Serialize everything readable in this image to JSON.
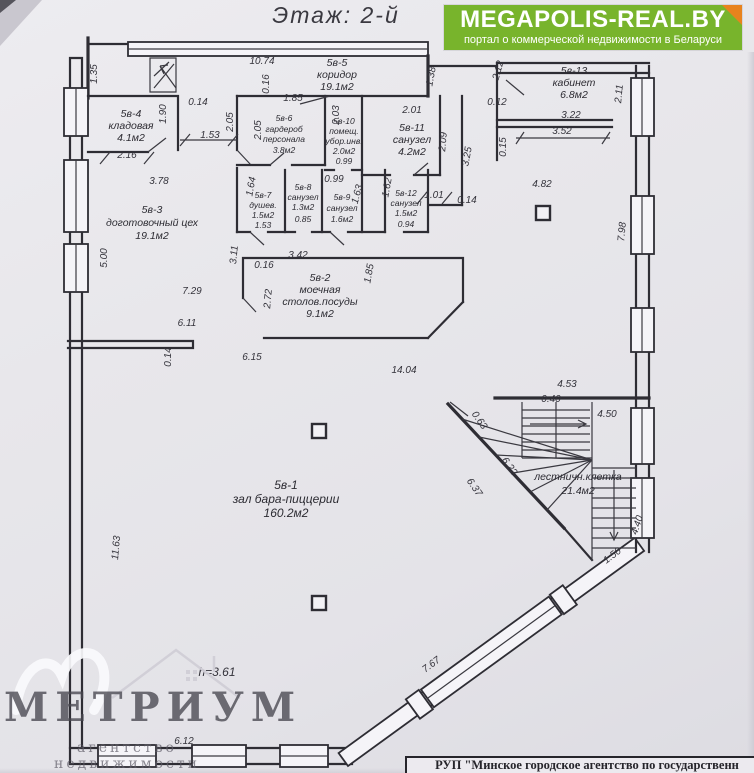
{
  "title": "Этаж: 2-й",
  "banner": {
    "brand": "MEGAPOLIS-REAL.BY",
    "tagline": "портал о коммерческой недвижимости в Беларуси",
    "bg_color": "#78b42c",
    "corner_color": "#e8831d"
  },
  "note_height": "h=3.61",
  "rooms": [
    {
      "id": "5в-4",
      "name": "кладовая",
      "area": "4.1м2"
    },
    {
      "id": "5в-5",
      "name": "коридор",
      "area": "19.1м2"
    },
    {
      "id": "5в-6",
      "name": "гардероб",
      "name2": "персонала",
      "area": "3.8м2"
    },
    {
      "id": "5в-10",
      "name": "помещ.",
      "name2": "убор.инв.",
      "area": "2.0м2",
      "extra": "0.99"
    },
    {
      "id": "5в-11",
      "name": "санузел",
      "area": "4.2м2"
    },
    {
      "id": "5в-13",
      "name": "кабинет",
      "area": "6.8м2"
    },
    {
      "id": "5в-7",
      "name": "душев.",
      "area": "1.5м2",
      "extra": "1.53"
    },
    {
      "id": "5в-8",
      "name": "санузел",
      "area": "1.3м2",
      "extra": "0.85"
    },
    {
      "id": "5в-9",
      "name": "санузел",
      "area": "1.6м2"
    },
    {
      "id": "5в-12",
      "name": "санузел",
      "area": "1.5м2",
      "extra": "0.94"
    },
    {
      "id": "5в-3",
      "name": "доготовочный цех",
      "area": "19.1м2"
    },
    {
      "id": "5в-2",
      "name": "моечная",
      "name2": "столов.посуды",
      "area": "9.1м2"
    },
    {
      "id": "5в-1",
      "name": "зал бара-пиццерии",
      "area": "160.2м2"
    },
    {
      "id": "",
      "name": "лестничн.клетка",
      "area": "21.4м2"
    }
  ],
  "dims": [
    "1.35",
    "10.74",
    "0.16",
    "1.85",
    "1.38",
    "2.12",
    "2.11",
    "0.12",
    "3.22",
    "3.52",
    "0.15",
    "0.14",
    "1.90",
    "2.05",
    "2.05",
    "1.53",
    "2.16",
    "3.78",
    "2.01",
    "2.03",
    "2.09",
    "3.25",
    "1.64",
    "0.99",
    "1.63",
    "1.62",
    "1.01",
    "0.14",
    "4.82",
    "5.00",
    "3.11",
    "7.98",
    "0.16",
    "3.42",
    "1.85",
    "2.72",
    "7.29",
    "6.11",
    "0.14",
    "6.15",
    "14.04",
    "4.53",
    "0.40",
    "0.63",
    "4.50",
    "6.22",
    "6.37",
    "4.40",
    "1.50",
    "11.63",
    "7.67",
    "6.12"
  ],
  "watermark": {
    "name": "МЕТРИУМ",
    "tagline": "агентство недвижимости"
  },
  "footer": {
    "text": "РУП \"Минское городское агентство по государственн"
  }
}
